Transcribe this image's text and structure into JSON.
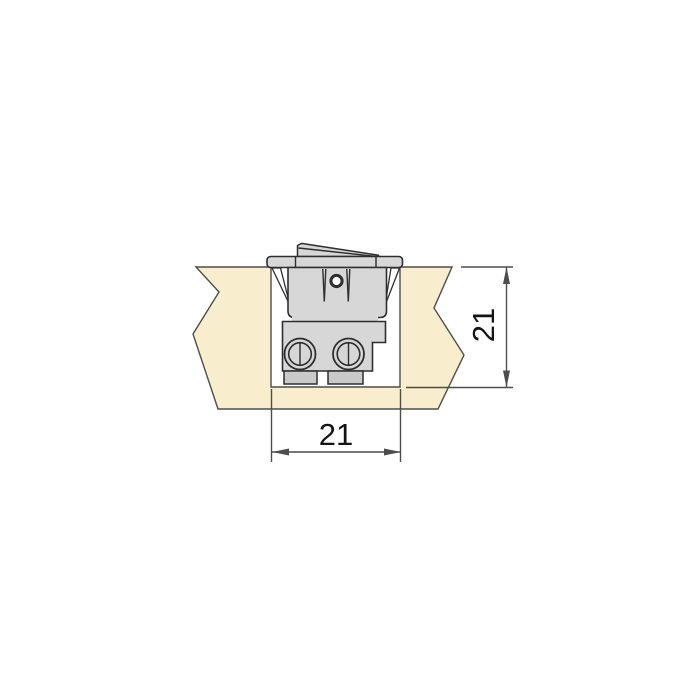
{
  "drawing": {
    "name": "rocker-switch-panel-mount-cross-section",
    "unit": "mm",
    "dimension_width": {
      "value": "21"
    },
    "dimension_depth": {
      "value": "21"
    },
    "components": [
      "mounting-panel",
      "panel-cutout",
      "rocker-actuator",
      "switch-bezel",
      "retaining-clip-left",
      "retaining-clip-right",
      "switch-body-upper",
      "switch-marking-circle",
      "contact-pin-left",
      "contact-pin-right",
      "switch-body-lower",
      "terminal-screw-left",
      "terminal-screw-right",
      "terminal-tab-left",
      "terminal-tab-right"
    ]
  },
  "colors": {
    "background": "#ffffff",
    "panel_fill": "#f8eecd",
    "panel_stroke": "#4d4d4d",
    "switch_fill": "#d7d7d7",
    "switch_fill_dark": "#c9c9c9",
    "switch_stroke": "#2e2e2e",
    "dimension_line": "#4d4d4d",
    "dimension_text": "#141414"
  }
}
